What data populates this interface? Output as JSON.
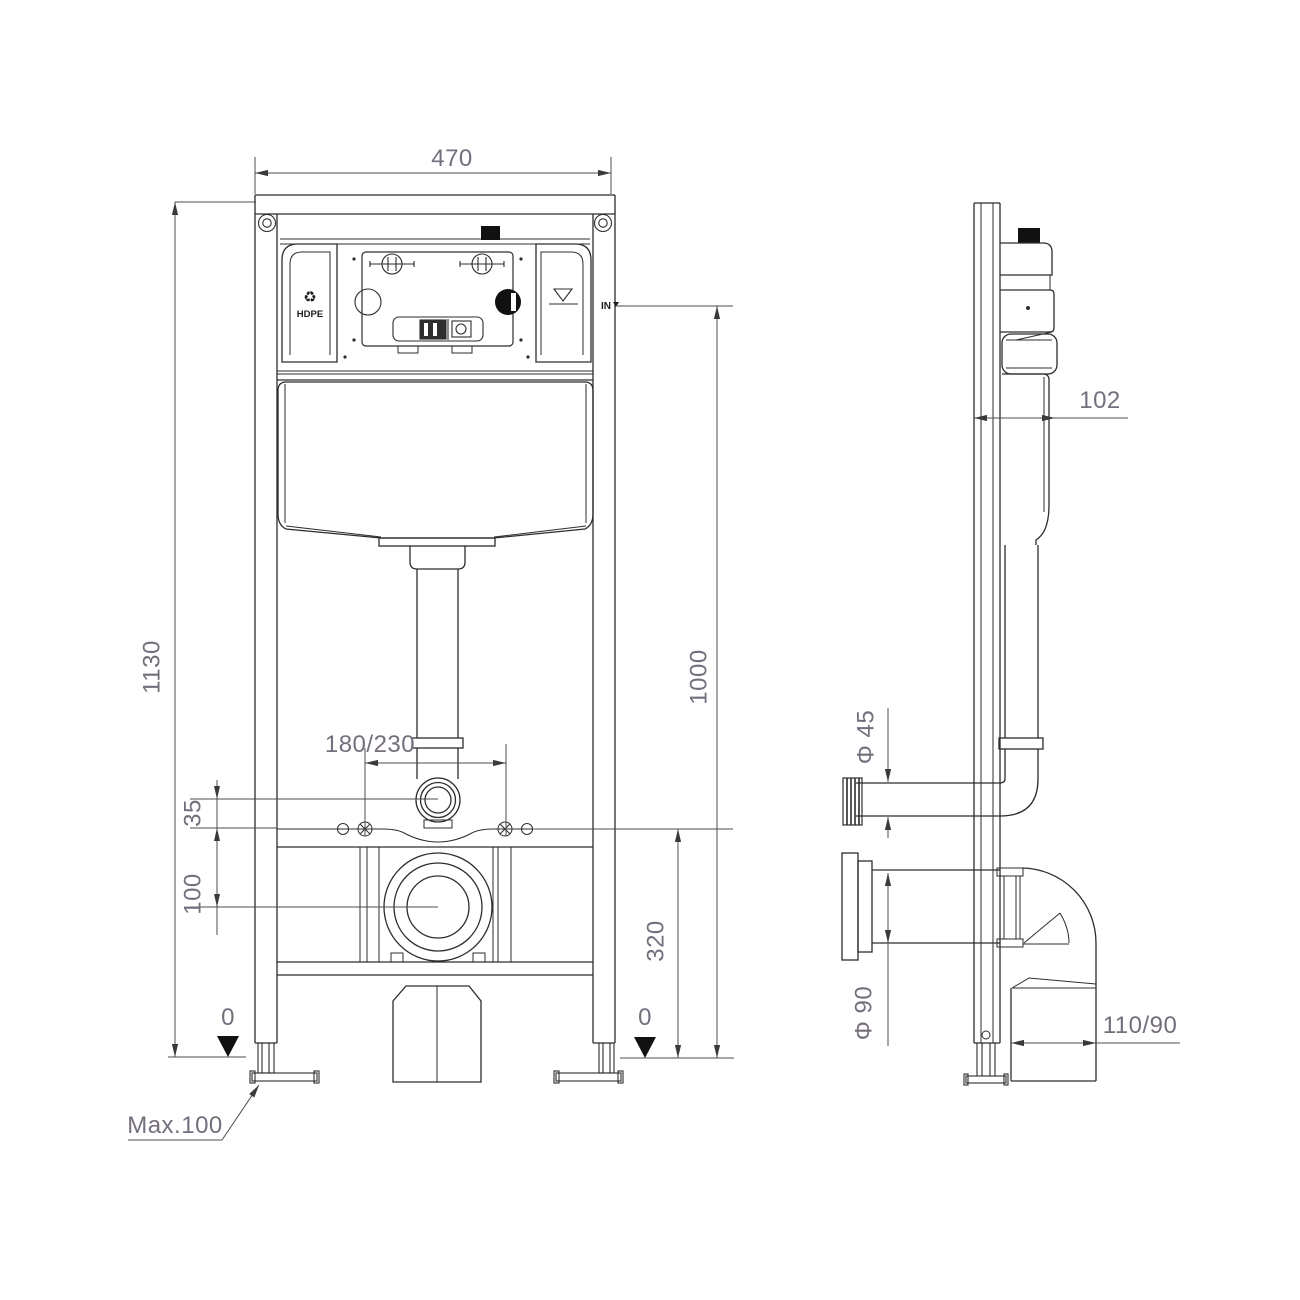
{
  "drawing": {
    "type": "technical-installation-drawing",
    "subject": "concealed-cistern-wc-frame",
    "front_view": {
      "dim_width_top": "470",
      "dim_total_height": "1130",
      "dim_inlet_height": "1000",
      "dim_bolt_spacing": "180/230",
      "dim_flush_elbow_offset": "35",
      "dim_waste_offset": "100",
      "dim_outlet_height": "320",
      "datum_left": "0",
      "datum_right": "0",
      "leg_adjustment": "Max.100",
      "label_material": "HDPE",
      "label_inlet": "IN",
      "recycle_icon": "♻"
    },
    "side_view": {
      "dim_depth": "102",
      "dim_flush_pipe_diameter": "Φ 45",
      "dim_waste_pipe_diameter": "Φ 90",
      "dim_outlet_bend": "110/90"
    },
    "colors": {
      "background": "#ffffff",
      "drawing_line": "#2d2d2d",
      "dimension_line": "#4d4d4d",
      "dimension_text": "#756e7c",
      "label_text": "#1c1c1c",
      "fill_black": "#111111"
    }
  }
}
